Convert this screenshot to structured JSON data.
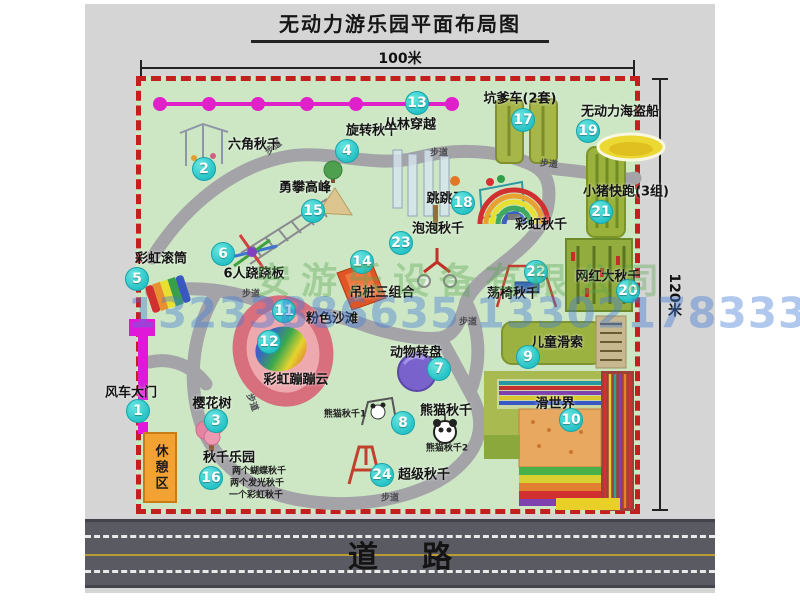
{
  "page": {
    "title": "无动力游乐园平面布局图"
  },
  "dimensions": {
    "top": "100米",
    "right": "120米"
  },
  "road": {
    "label": "道路"
  },
  "watermark": {
    "company": "安游乐设备有限公司",
    "phone": "13233886635 13302178333"
  },
  "path_label": "步道",
  "pois": {
    "gate": {
      "num": "1",
      "label": "风车大门"
    },
    "hexswing": {
      "num": "2",
      "label": "六角秋千"
    },
    "sakura": {
      "num": "3",
      "label": "樱花树"
    },
    "rotateswing": {
      "num": "4",
      "label": "旋转秋千"
    },
    "rainbowroller": {
      "num": "5",
      "label": "彩虹滚筒"
    },
    "seesaw": {
      "num": "6",
      "label": "6人跷跷板"
    },
    "carousel": {
      "num": "7",
      "label": "动物转盘"
    },
    "pandaswing": {
      "num": "8",
      "label": "熊猫秋千",
      "sub1": "熊猫秋千1",
      "sub2": "熊猫秋千2"
    },
    "kidszipline": {
      "num": "9",
      "label": "儿童滑索"
    },
    "slideworld": {
      "num": "10",
      "label": "滑世界"
    },
    "pinkbeach": {
      "num": "11",
      "label": "粉色沙滩"
    },
    "rainbowcloud": {
      "num": "12",
      "label": "彩虹蹦蹦云"
    },
    "jungle": {
      "num": "13",
      "label": "丛林穿越"
    },
    "hangpiles": {
      "num": "14",
      "label": "吊桩三组合"
    },
    "climbpeak": {
      "num": "15",
      "label": "勇攀高峰"
    },
    "swingpark": {
      "num": "16",
      "label": "秋千乐园",
      "sub1": "两个蝴蝶秋千",
      "sub2": "两个发光秋千",
      "sub3": "一个彩虹秋千"
    },
    "bumpercar": {
      "num": "17",
      "label": "坑爹车(2套)"
    },
    "jumphorse": {
      "num": "18",
      "label": "跳跳马"
    },
    "pirateship": {
      "num": "19",
      "label": "无动力海盗船"
    },
    "bigswing": {
      "num": "20",
      "label": "网红大秋千"
    },
    "pigrun": {
      "num": "21",
      "label": "小猪快跑(3组)"
    },
    "chairswing": {
      "num": "22",
      "label": "荡椅秋千"
    },
    "bubbleswing": {
      "num": "23",
      "label": "泡泡秋千"
    },
    "superswing": {
      "num": "24",
      "label": "超级秋千"
    },
    "rainbowswing": {
      "label": "彩虹秋千"
    },
    "restarea": {
      "label": "休憩区"
    }
  }
}
